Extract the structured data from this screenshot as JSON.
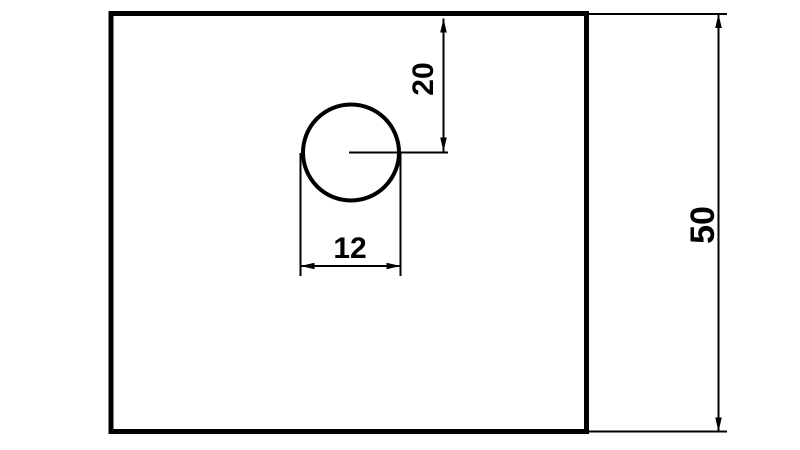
{
  "drawing": {
    "background_color": "#ffffff",
    "line_color": "#000000",
    "plate": {
      "description": "rectangular-plate-outline"
    },
    "hole": {
      "description": "circular-hole-with-centerline"
    },
    "dimensions": {
      "top_edge_to_hole_center": "20",
      "hole_width": "12",
      "plate_height": "50"
    }
  }
}
